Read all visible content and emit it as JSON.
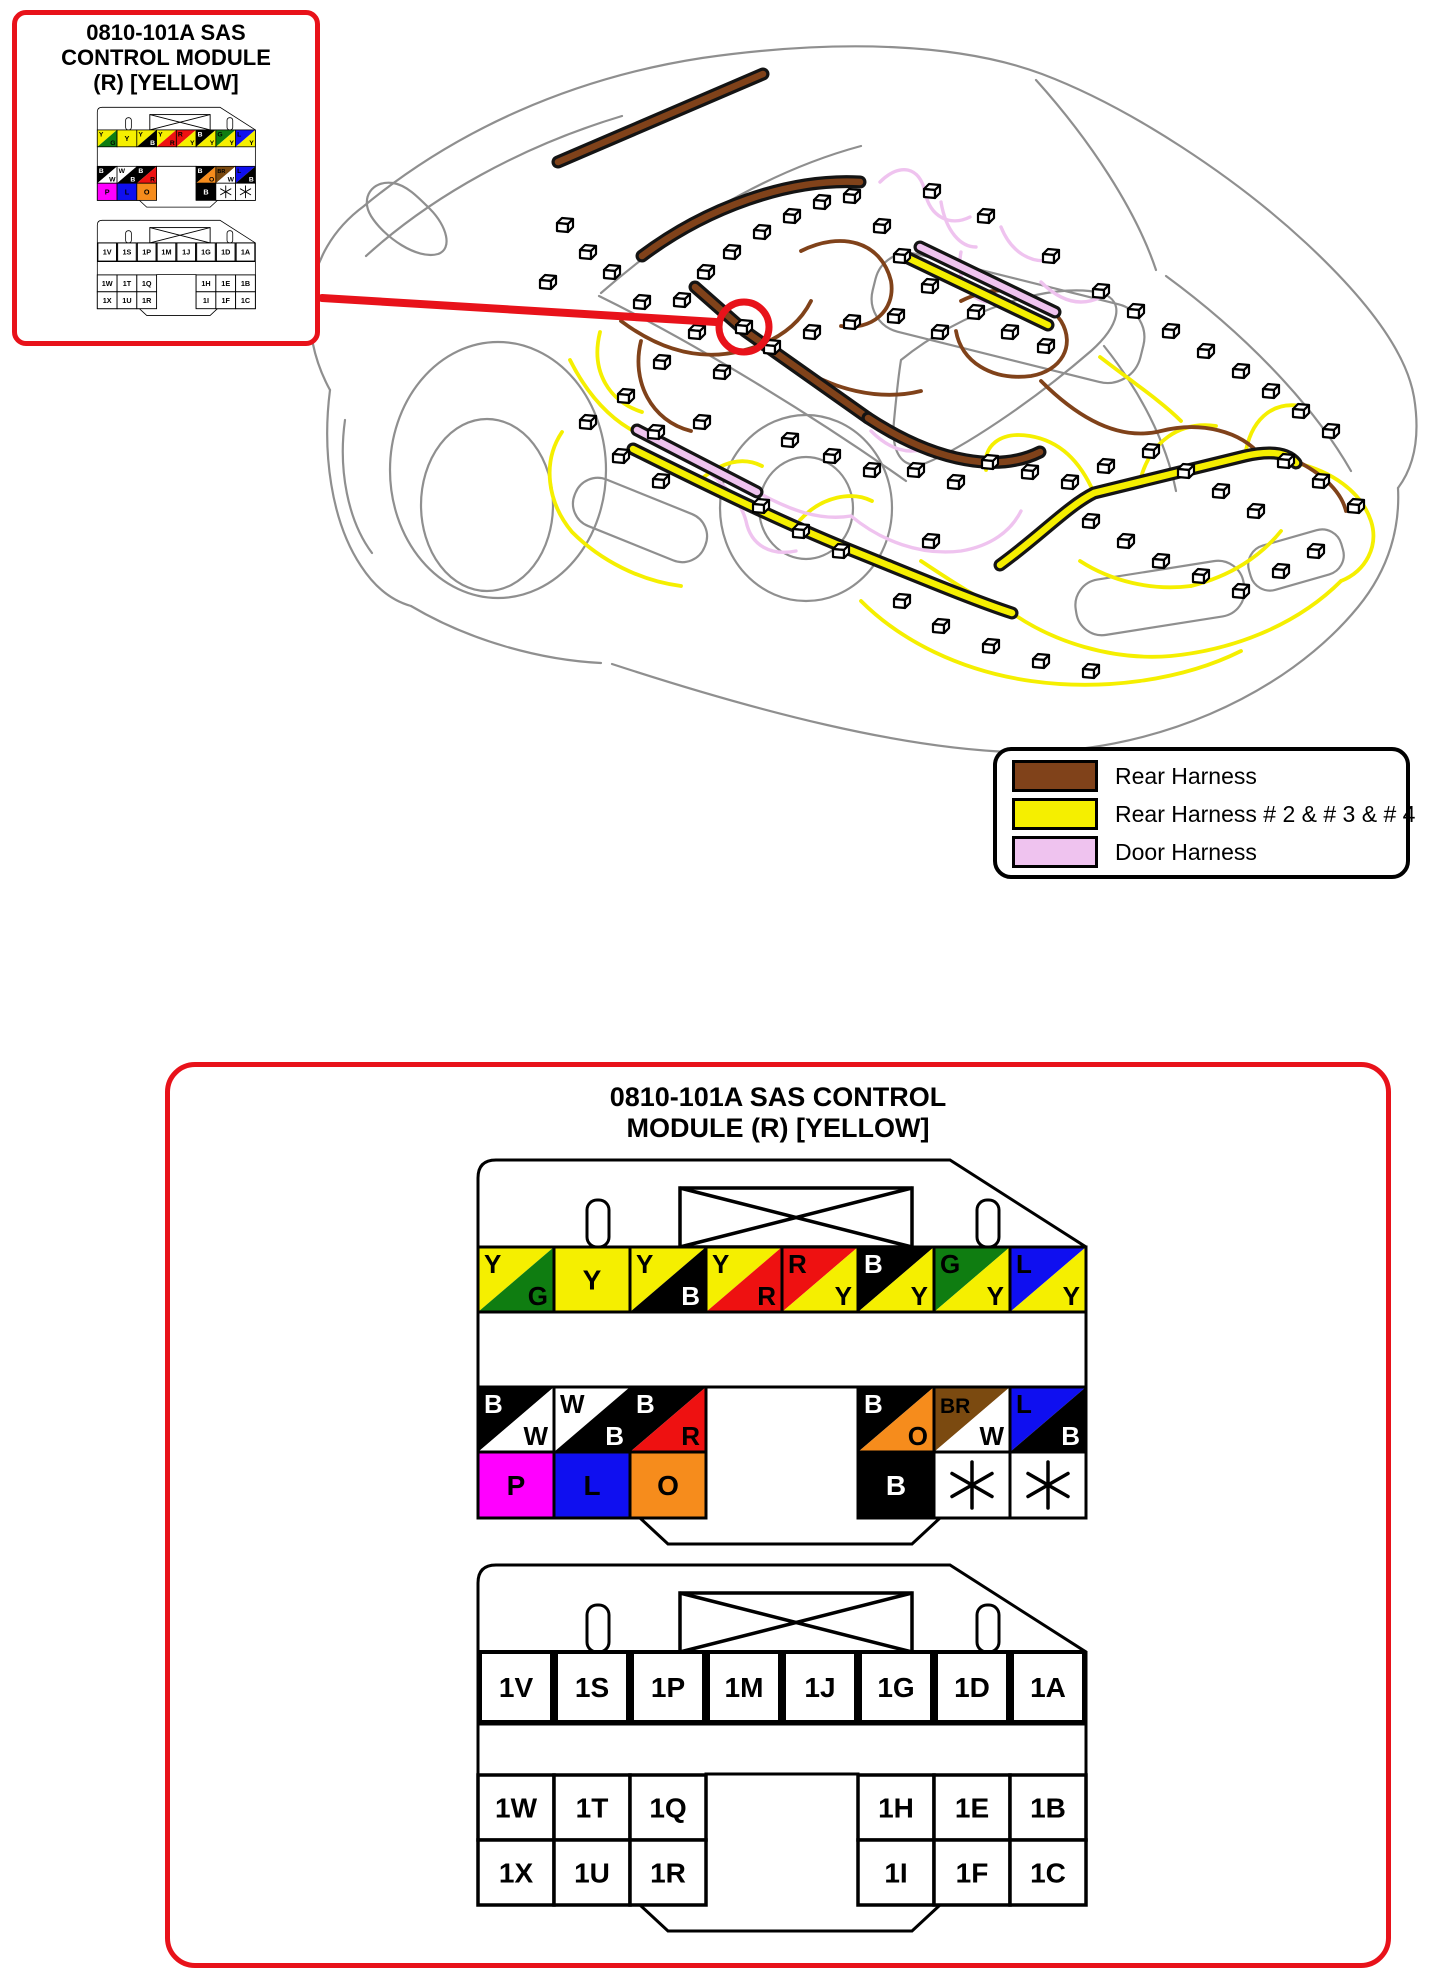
{
  "callout_box": {
    "title_lines": [
      "0810-101A SAS",
      "CONTROL MODULE",
      "(R) [YELLOW]"
    ]
  },
  "detail_box": {
    "title_lines": [
      "0810-101A SAS CONTROL",
      "MODULE (R) [YELLOW]"
    ]
  },
  "legend": {
    "items": [
      {
        "label": "Rear Harness",
        "color": "#80421a"
      },
      {
        "label": "Rear Harness # 2 & # 3 & # 4",
        "color": "#f5ef00"
      },
      {
        "label": "Door Harness",
        "color": "#efc3ef"
      }
    ]
  },
  "harness_colors": {
    "rear": "#80421a",
    "rear234": "#f5ef00",
    "door": "#efc3ef"
  },
  "callout_red": "#e8121a",
  "wire_palette": {
    "Y": "#f5ef00",
    "G": "#0f7d11",
    "R": "#ee1111",
    "B": "#000000",
    "L": "#0f0ff0",
    "W": "#ffffff",
    "P": "#ff00ff",
    "O": "#f68c1c",
    "BR": "#7b4a10"
  },
  "connector_color": {
    "row1": [
      [
        "Y",
        "G"
      ],
      [
        "Y"
      ],
      [
        "Y",
        "B"
      ],
      [
        "Y",
        "R"
      ],
      [
        "R",
        "Y"
      ],
      [
        "B",
        "Y"
      ],
      [
        "G",
        "Y"
      ],
      [
        "L",
        "Y"
      ]
    ],
    "row2_left": [
      [
        "B",
        "W"
      ],
      [
        "W",
        "B"
      ],
      [
        "B",
        "R"
      ]
    ],
    "row2_right": [
      [
        "B",
        "O"
      ],
      [
        "BR",
        "W"
      ],
      [
        "L",
        "B"
      ]
    ],
    "row3_left": [
      [
        "P"
      ],
      [
        "L"
      ],
      [
        "O"
      ]
    ],
    "row3_right": [
      [
        "B"
      ],
      [
        "*"
      ],
      [
        "*"
      ]
    ]
  },
  "connector_pins": {
    "row1": [
      "1V",
      "1S",
      "1P",
      "1M",
      "1J",
      "1G",
      "1D",
      "1A"
    ],
    "row2_left": [
      "1W",
      "1T",
      "1Q"
    ],
    "row2_right": [
      "1H",
      "1E",
      "1B"
    ],
    "row3_left": [
      "1X",
      "1U",
      "1R"
    ],
    "row3_right": [
      "1I",
      "1F",
      "1C"
    ]
  }
}
